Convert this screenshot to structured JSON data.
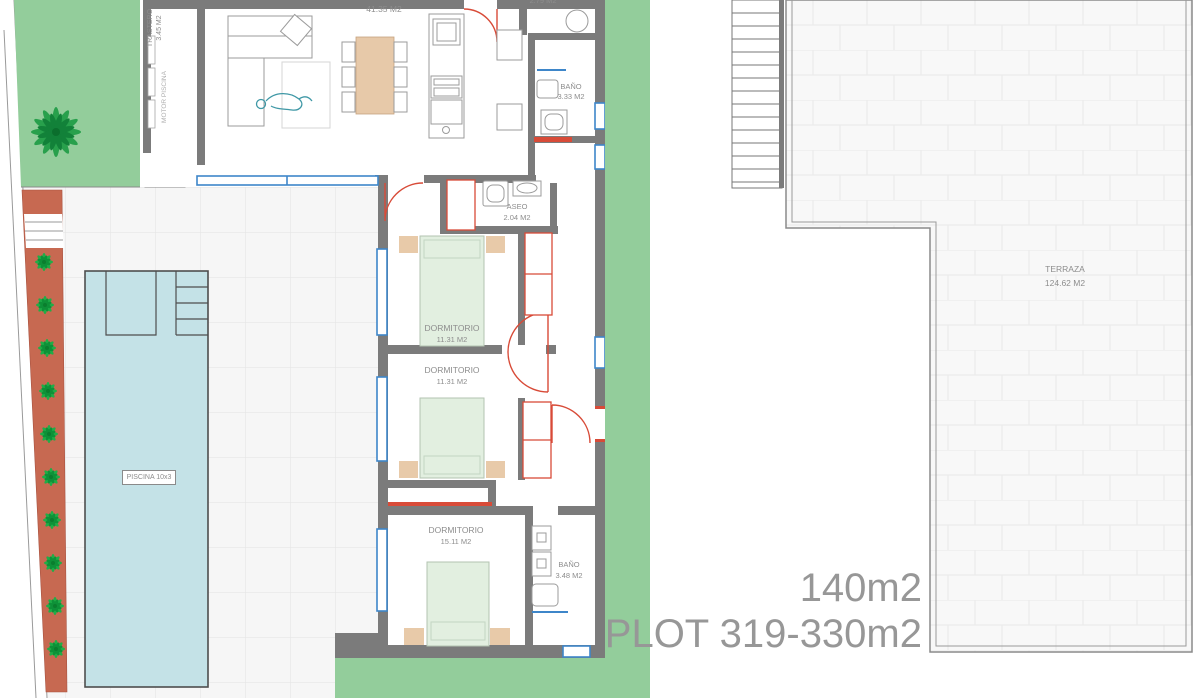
{
  "floor_plan": {
    "rooms": {
      "trastero": {
        "name": "TRASTERO",
        "area": "3.45 M2"
      },
      "motor_piscina": {
        "name": "MOTOR PISCINA"
      },
      "salon": {
        "area": "41.35 M2"
      },
      "lavadero": {
        "area": "2.79 M2"
      },
      "bano_1": {
        "name": "BAÑO",
        "area": "3.33 M2"
      },
      "aseo": {
        "name": "ASEO",
        "area": "2.04 M2"
      },
      "dormitorio_1": {
        "name": "DORMITORIO",
        "area": "11.31 M2"
      },
      "dormitorio_2": {
        "name": "DORMITORIO",
        "area": "11.31 M2"
      },
      "dormitorio_3": {
        "name": "DORMITORIO",
        "area": "15.11 M2"
      },
      "bano_2": {
        "name": "BAÑO",
        "area": "3.48 M2"
      }
    },
    "outdoor": {
      "piscina": {
        "label": "PISCINA 10x3"
      },
      "terraza": {
        "name": "TERRAZA",
        "area": "124.62 M2"
      }
    },
    "summary": {
      "built_area": "140m2",
      "plot": "PLOT 319-330m2"
    },
    "colors": {
      "garden_green": "#93cd9b",
      "pool_blue": "#c4e2e7",
      "planter_terracotta": "#c76951",
      "wall_gray": "#7b7b7b",
      "window_blue": "#3e86c9",
      "door_red": "#d84b38",
      "bed_green": "#e2efe0",
      "wood_tan": "#e8caa9",
      "label_gray": "#8d8d8d"
    }
  }
}
